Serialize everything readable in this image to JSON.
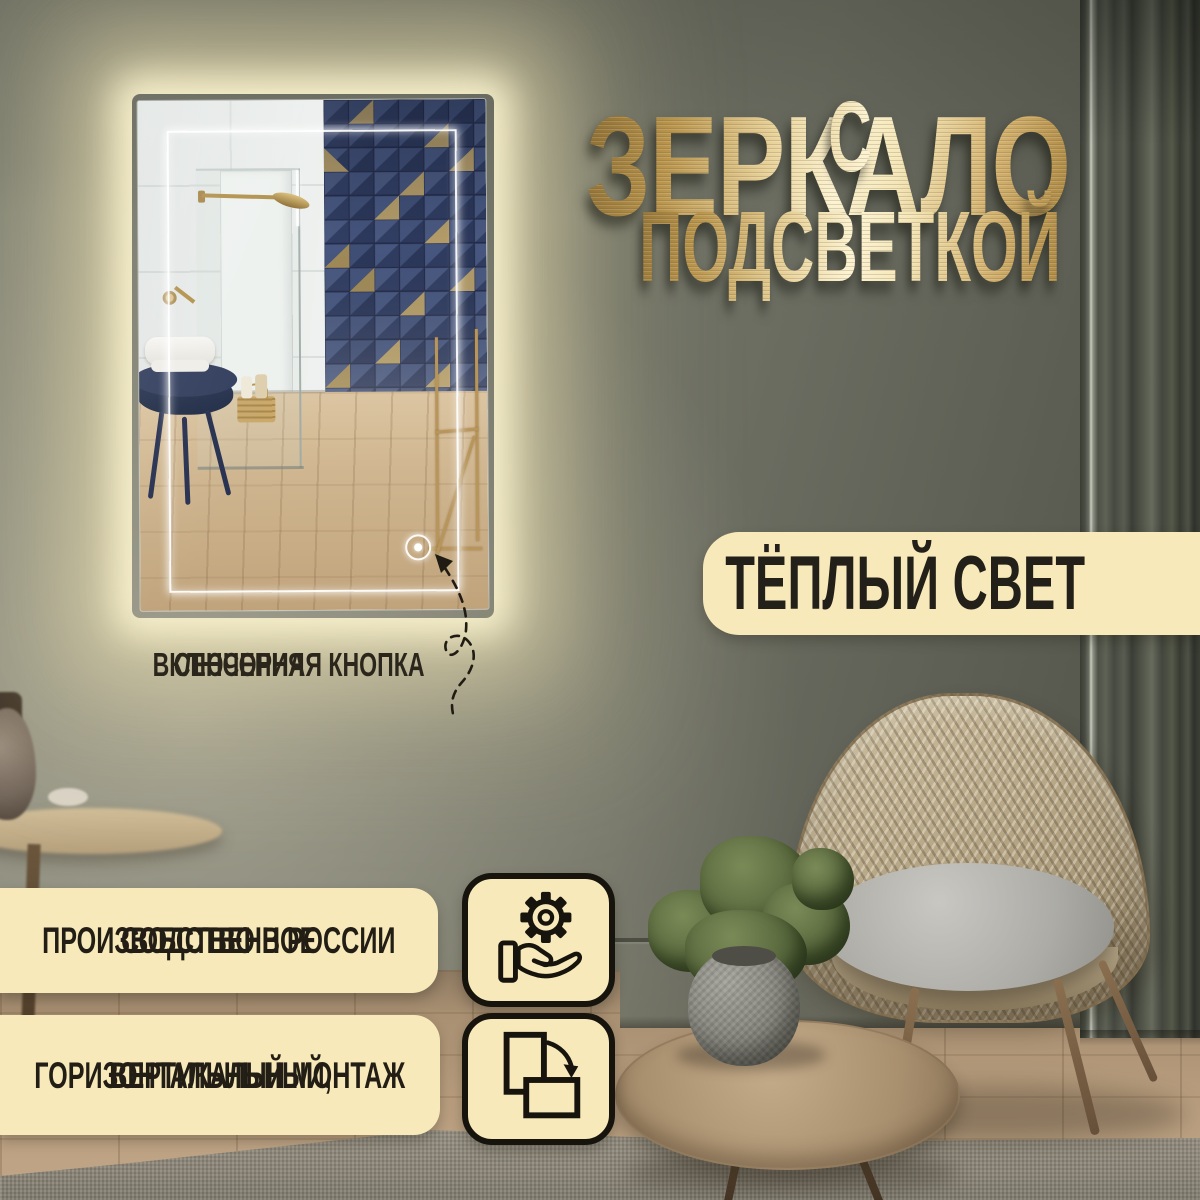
{
  "banner": {
    "title": {
      "line1": "ЗЕРКАЛО",
      "line2": "С ПОДСВЕТКОЙ"
    },
    "warm_light_badge": {
      "label": "ТЁПЛЫЙ СВЕТ"
    },
    "touch_button_caption": {
      "line1": "СЕНСОРНАЯ КНОПКА",
      "line2": "ВКЛЮЧЕНИЯ"
    },
    "feature_badges": [
      {
        "line1": "СОБСТВЕННОЕ",
        "line2": "ПРОИЗВОДСТВО В РОССИИ",
        "icon": "gear-in-hand-icon"
      },
      {
        "line1": "ВЕРТИКАЛЬНЫЙ,",
        "line2": "ГОРИЗОНТАЛЬНЫЙ МОНТАЖ",
        "icon": "portrait-landscape-rotation-icon"
      }
    ],
    "colors": {
      "gold_light": "#fdf4d4",
      "gold_dark": "#8f7136",
      "badge_bg": "#f7e9ba",
      "badge_text": "#221e15",
      "wall_olive": "#6e7064",
      "glow_warm": "#f5ecc2",
      "mosaic_navy": "#3e4d74",
      "mosaic_gold": "#b29b68"
    }
  }
}
